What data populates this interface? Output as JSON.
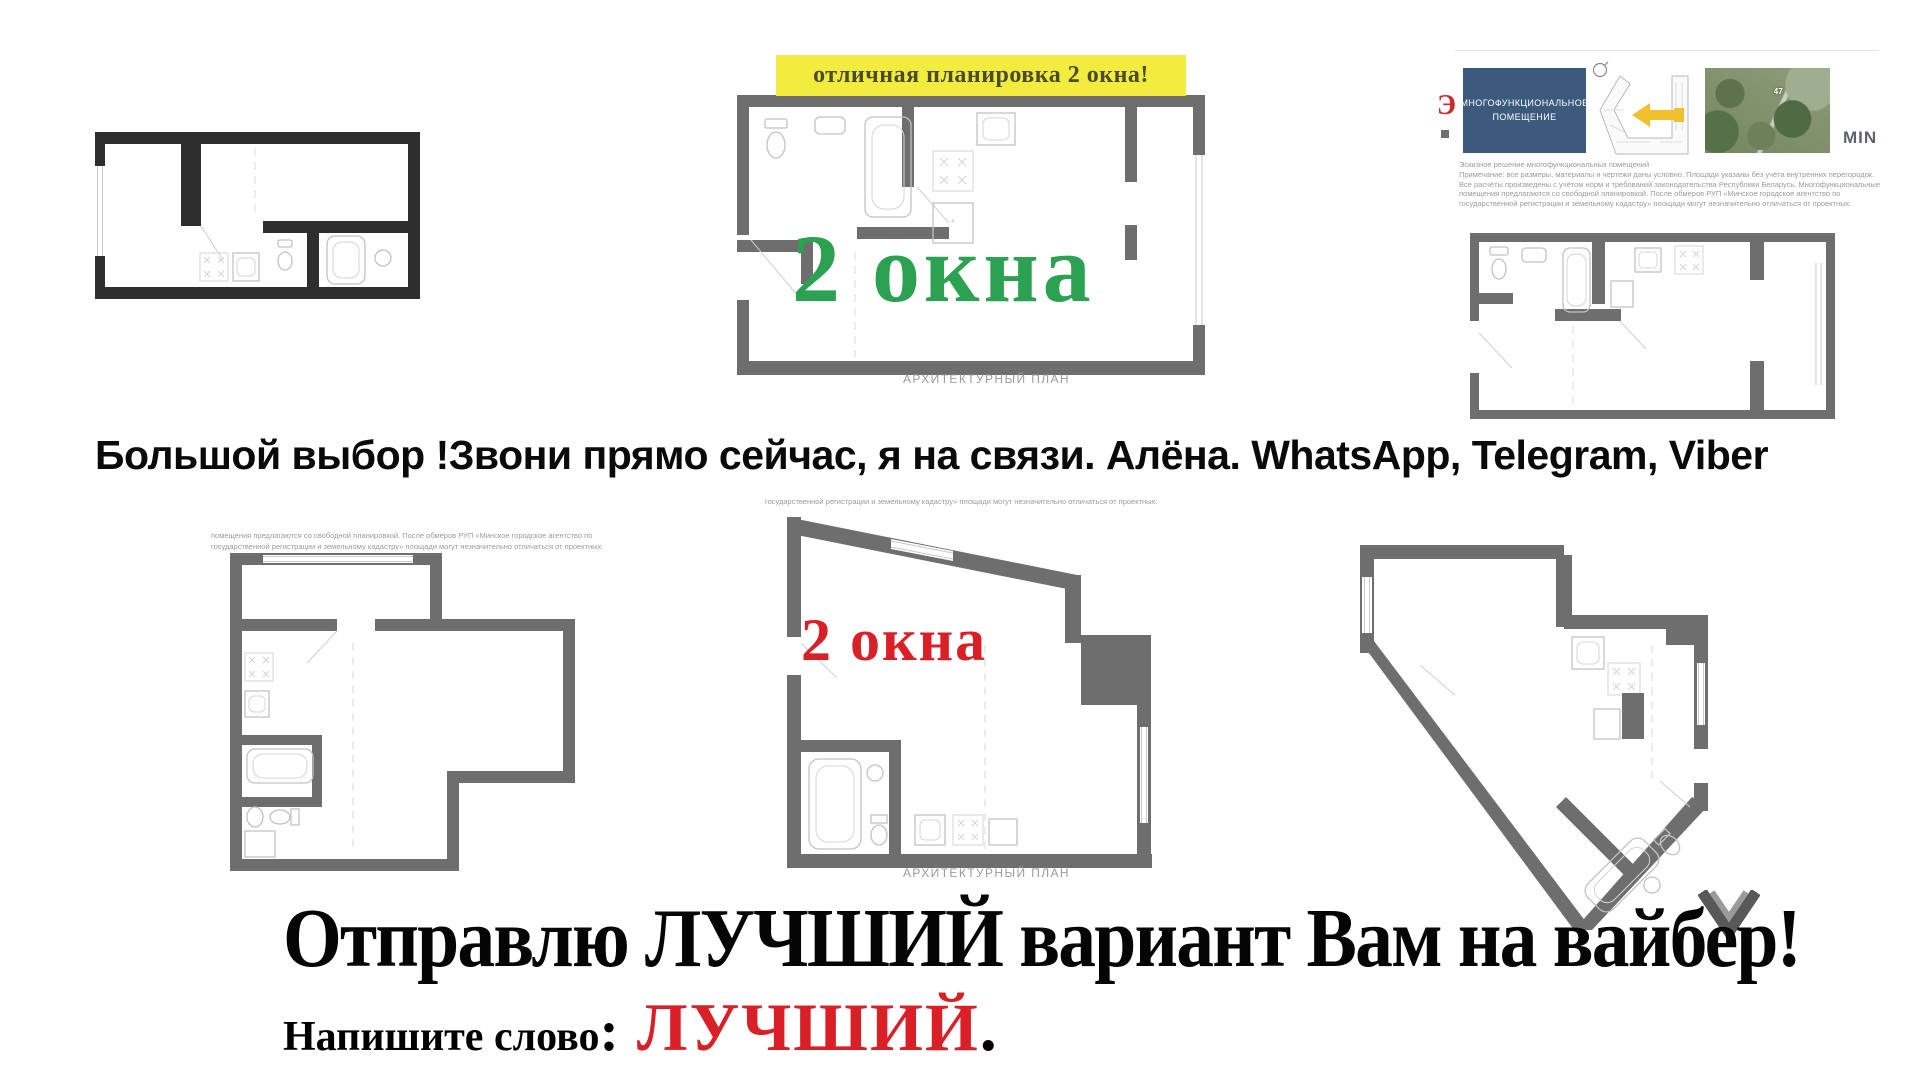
{
  "colors": {
    "banner_bg": "#f2ec3e",
    "banner_text": "#4b4b30",
    "green_accent": "#2ca152",
    "red_accent": "#d92027",
    "wall_dark": "#2e2e2e",
    "wall_gray": "#6e6e6e",
    "note_gray": "#9b9b9b",
    "navy_box": "#3c5a7c",
    "yellow_arrow": "#f0c02e"
  },
  "banner": {
    "text": "отличная планировка 2 окна!"
  },
  "top_center_plan": {
    "overlay": "2 окна",
    "caption": "АРХИТЕКТУРНЫЙ ПЛАН"
  },
  "info_card": {
    "logo_fragment": "Э",
    "title_line1": "МНОГОФУНКЦИОНАЛЬНОЕ",
    "title_line2": "ПОМЕЩЕНИЕ",
    "map_label": "47",
    "min_label": "MIN",
    "note_lines": [
      "Эскизное решение многофункциональных помещений",
      "Примечание: все размеры, материалы и чертежи даны условно. Площади указаны без учёта внутренних перегородок.",
      "Все расчёты произведены с учётом норм и требований законодательства Республики Беларусь. Многофункциональные",
      "помещения предлагаются со свободной планировкой. После обмеров РУП «Минское городское агентство по",
      "государственной регистрации и земельному кадастру» площади могут незначительно отличаться от проектных."
    ]
  },
  "headline": {
    "text": "Большой выбор !Звони прямо сейчас, я на связи. Алёна. WhatsApp, Telegram, Viber"
  },
  "bottom_left_plan": {
    "note_line1": "помещения предлагаются со свободной планировкой. После обмеров РУП «Минское городское агентство по",
    "note_line2": "государственной регистрации и земельному кадастру» площади могут незначительно отличаться от проектных."
  },
  "bottom_center_plan": {
    "note": "государственной регистрации и земельному кадастру» площади могут незначительно отличаться от проектных.",
    "overlay": "2 окна",
    "caption": "АРХИТЕКТУРНЫЙ ПЛАН"
  },
  "footer": {
    "line1": "Отправлю ЛУЧШИЙ вариант Вам на вайбер!",
    "prompt": "Напишите слово",
    "colon": ":",
    "keyword": "ЛУЧШИЙ",
    "period": "."
  }
}
